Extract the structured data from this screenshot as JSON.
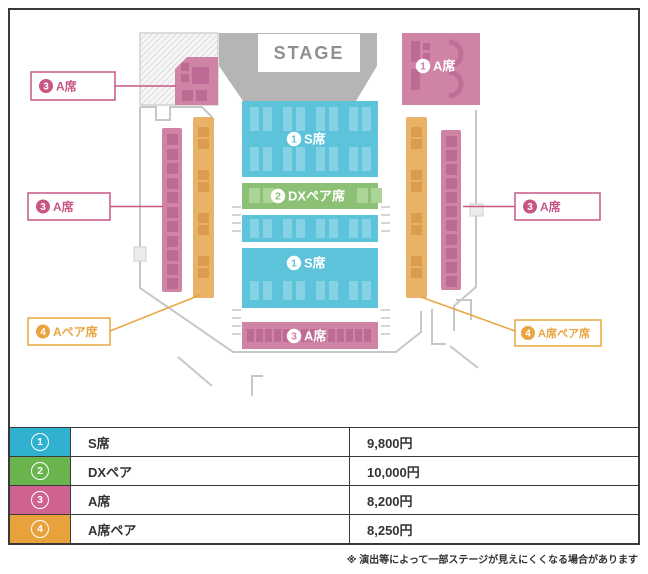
{
  "map": {
    "stage_label": "STAGE",
    "sections": {
      "a_top_right": {
        "num": "1",
        "label": "A席"
      },
      "s_upper": {
        "num": "1",
        "label": "S席"
      },
      "dx_pair": {
        "num": "2",
        "label": "DXペア席"
      },
      "s_lower": {
        "num": "1",
        "label": "S席"
      },
      "a_bottom": {
        "num": "3",
        "label": "A席"
      }
    },
    "callouts": {
      "stage_left_a": {
        "num": "3",
        "label": "A席"
      },
      "left_a": {
        "num": "3",
        "label": "A席"
      },
      "left_a_pair": {
        "num": "4",
        "label": "Aペア席"
      },
      "right_a": {
        "num": "3",
        "label": "A席"
      },
      "right_a_pair": {
        "num": "4",
        "label": "A席ペア席"
      }
    }
  },
  "legend": {
    "rows": [
      {
        "num": "1",
        "name": "S席",
        "price": "9,800円",
        "color": "#2fb1cf"
      },
      {
        "num": "2",
        "name": "DXペア",
        "price": "10,000円",
        "color": "#69b44d"
      },
      {
        "num": "3",
        "name": "A席",
        "price": "8,200円",
        "color": "#ce6390"
      },
      {
        "num": "4",
        "name": "A席ペア",
        "price": "8,250円",
        "color": "#e9a13c"
      }
    ]
  },
  "note": "※ 演出等によって一部ステージが見えにくくなる場合があります",
  "colors": {
    "map_s": "#5cc3da",
    "map_s_mark": "#84d2e3",
    "map_dx": "#8cc074",
    "map_dx_mark": "#aad498",
    "map_a": "#cf84a6",
    "map_a_mark": "#bd6a94",
    "map_pair": "#e8b369",
    "map_pair_mark": "#dc9c4e",
    "callout_a": "#c75685",
    "callout_pair": "#e9a53f",
    "stage": "#b5b5b5",
    "stage_text": "#8f8f8f",
    "wall": "#c7c7c7"
  }
}
